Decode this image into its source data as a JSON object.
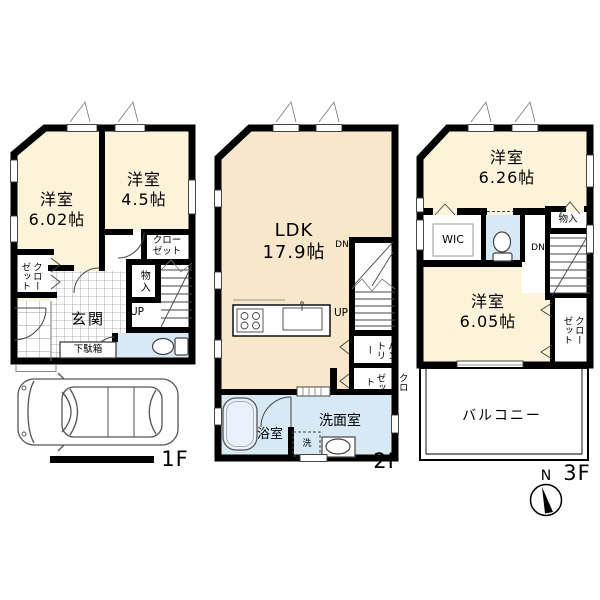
{
  "colors": {
    "wall": "#000000",
    "cream": "#FBF3DA",
    "peach": "#F9E7CC",
    "wet": "#D7E9F5",
    "white": "#FFFFFF"
  },
  "floor1": {
    "label": "1F",
    "room1_name": "洋室",
    "room1_size": "6.02帖",
    "room2_name": "洋室",
    "room2_size": "4.5帖",
    "closet_right_line1": "クロー",
    "closet_right_line2": "ゼット",
    "closet_left_col1": "クロー",
    "closet_left_col2": "ゼット",
    "storage": "物入",
    "entrance": "玄関",
    "shoe_box": "下駄箱",
    "stairs_up": "UP"
  },
  "floor2": {
    "label": "2F",
    "ldk_name": "LDK",
    "ldk_size": "17.9帖",
    "stairs_down": "DN",
    "stairs_up": "UP",
    "pantry_col1": "パン",
    "pantry_col2": "トリー",
    "closet_col1": "クロー",
    "closet_col2": "ゼット",
    "bathroom": "浴室",
    "washroom": "洗面室",
    "laundry": "洗"
  },
  "floor3": {
    "label": "3F",
    "room1_name": "洋室",
    "room1_size": "6.26帖",
    "wic": "WIC",
    "storage": "物入",
    "stairs_down": "DN",
    "room2_name": "洋室",
    "room2_size": "6.05帖",
    "closet_col1": "クロー",
    "closet_col2": "ゼット",
    "balcony": "バルコニー",
    "compass_north": "N"
  }
}
